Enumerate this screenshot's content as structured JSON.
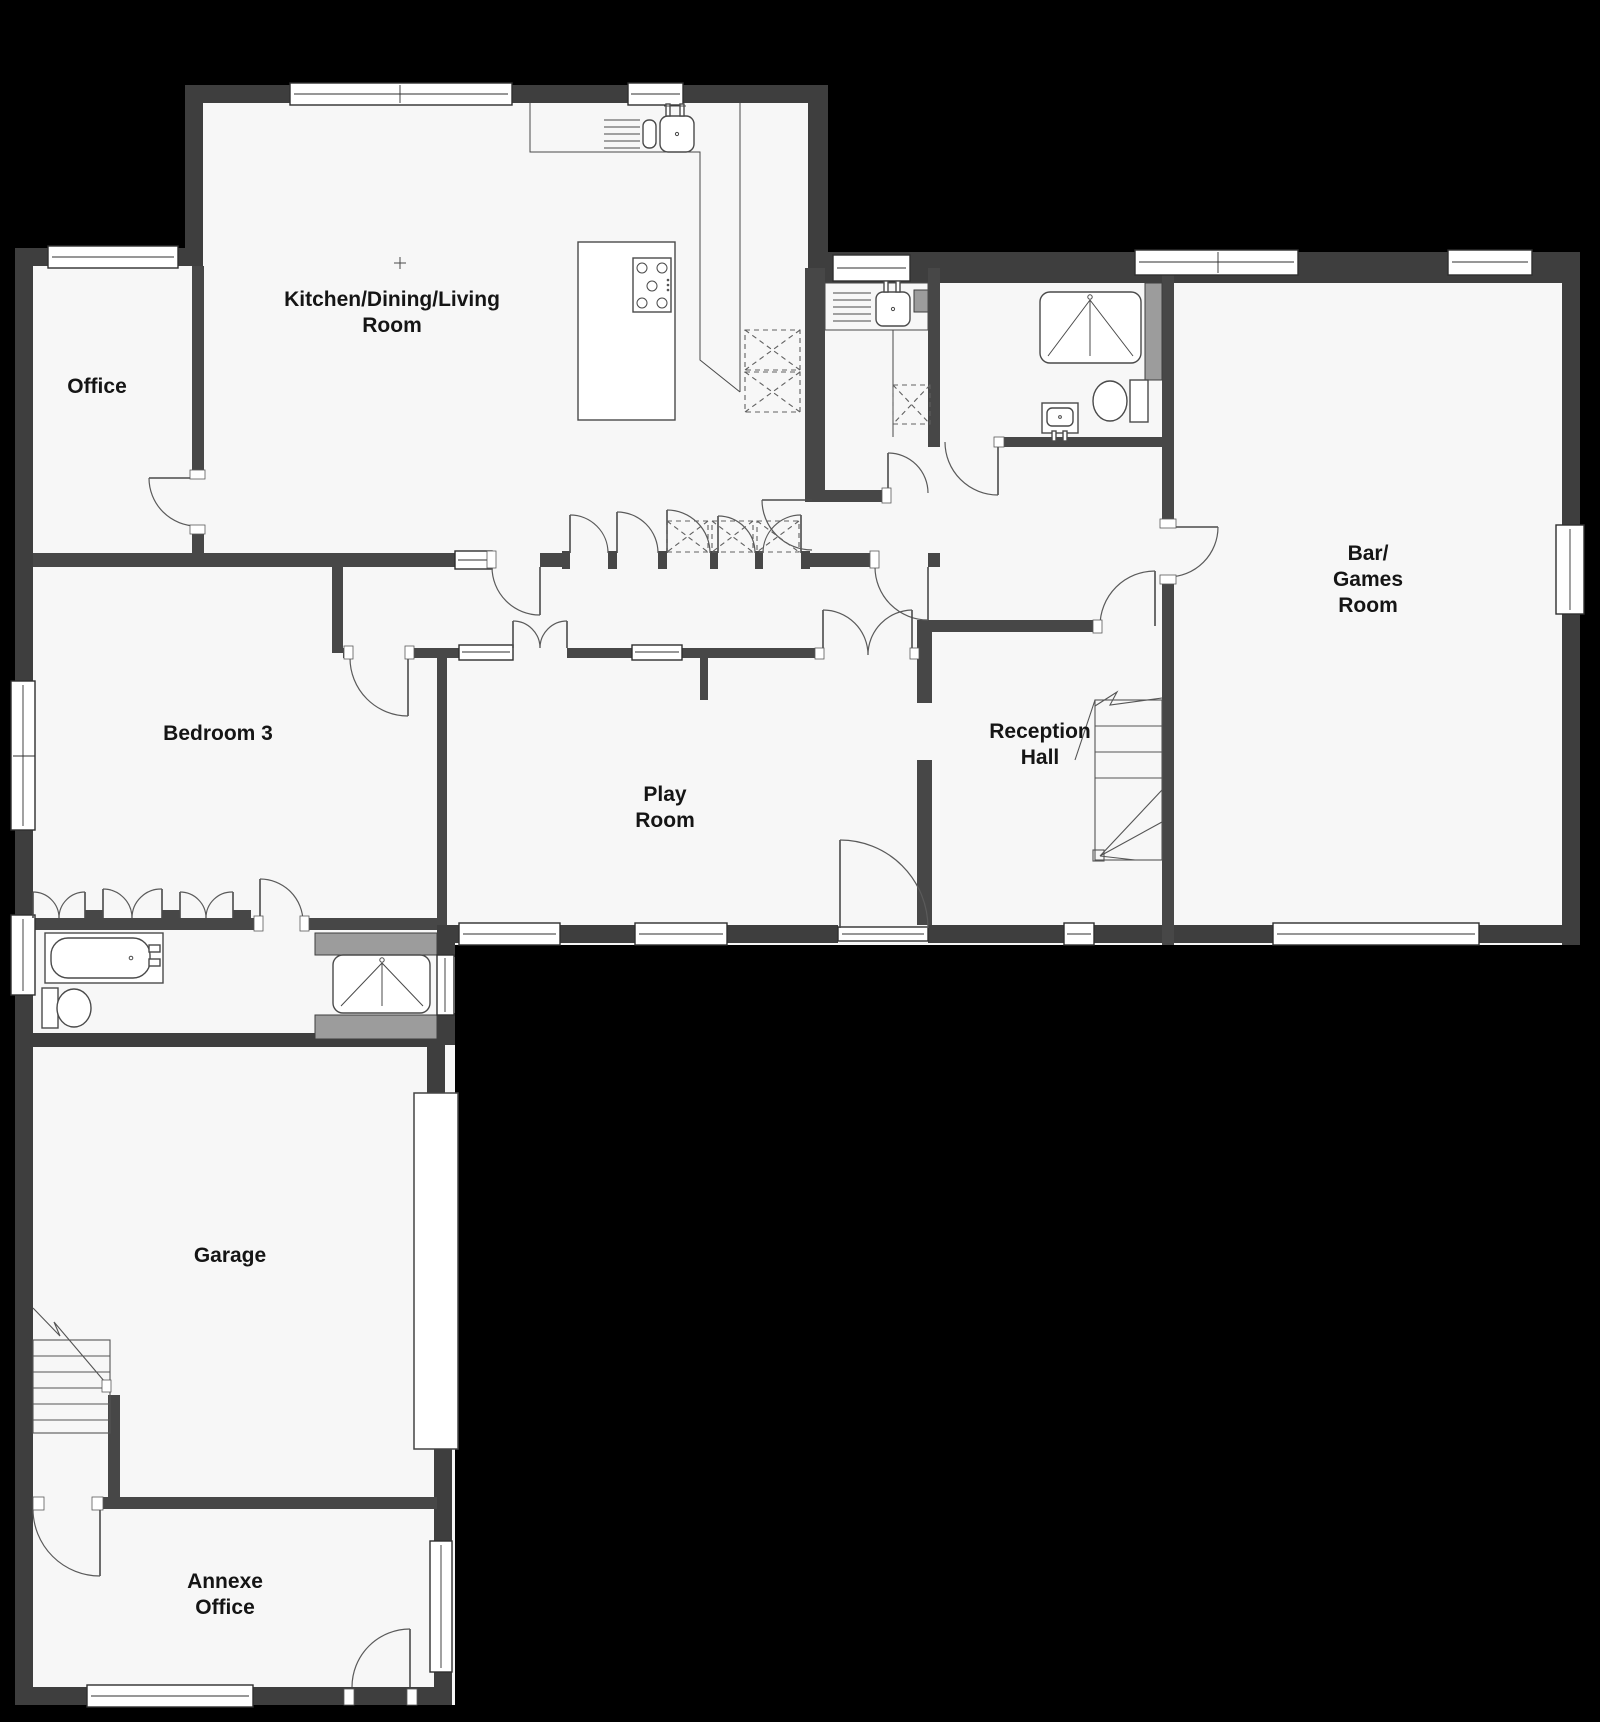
{
  "plan_title": "Ground floor plan",
  "colors": {
    "background": "#000000",
    "floor": "#f7f7f7",
    "wall": "#3e3e3e",
    "fixture_gray": "#9c9c9c",
    "label_text": "#151515"
  },
  "rooms": [
    {
      "id": "kitchen",
      "lines": [
        "Kitchen/Dining/Living",
        "Room"
      ]
    },
    {
      "id": "office",
      "lines": [
        "Office"
      ]
    },
    {
      "id": "bedroom3",
      "lines": [
        "Bedroom 3"
      ]
    },
    {
      "id": "playroom",
      "lines": [
        "Play",
        "Room"
      ]
    },
    {
      "id": "reception",
      "lines": [
        "Reception",
        "Hall"
      ]
    },
    {
      "id": "bargames",
      "lines": [
        "Bar/",
        "Games",
        "Room"
      ]
    },
    {
      "id": "garage",
      "lines": [
        "Garage"
      ]
    },
    {
      "id": "annexe",
      "lines": [
        "Annexe",
        "Office"
      ]
    }
  ],
  "fixtures": [
    "kitchen-sink",
    "island-hob",
    "utility-sink",
    "shower-tray-ensuite",
    "toilet-ensuite",
    "basin-ensuite",
    "bathtub",
    "toilet-bathroom",
    "shower-tray-bathroom",
    "reception-stairs",
    "garage-stairs",
    "garage-door",
    "wardrobes",
    "storage-cupboards"
  ]
}
